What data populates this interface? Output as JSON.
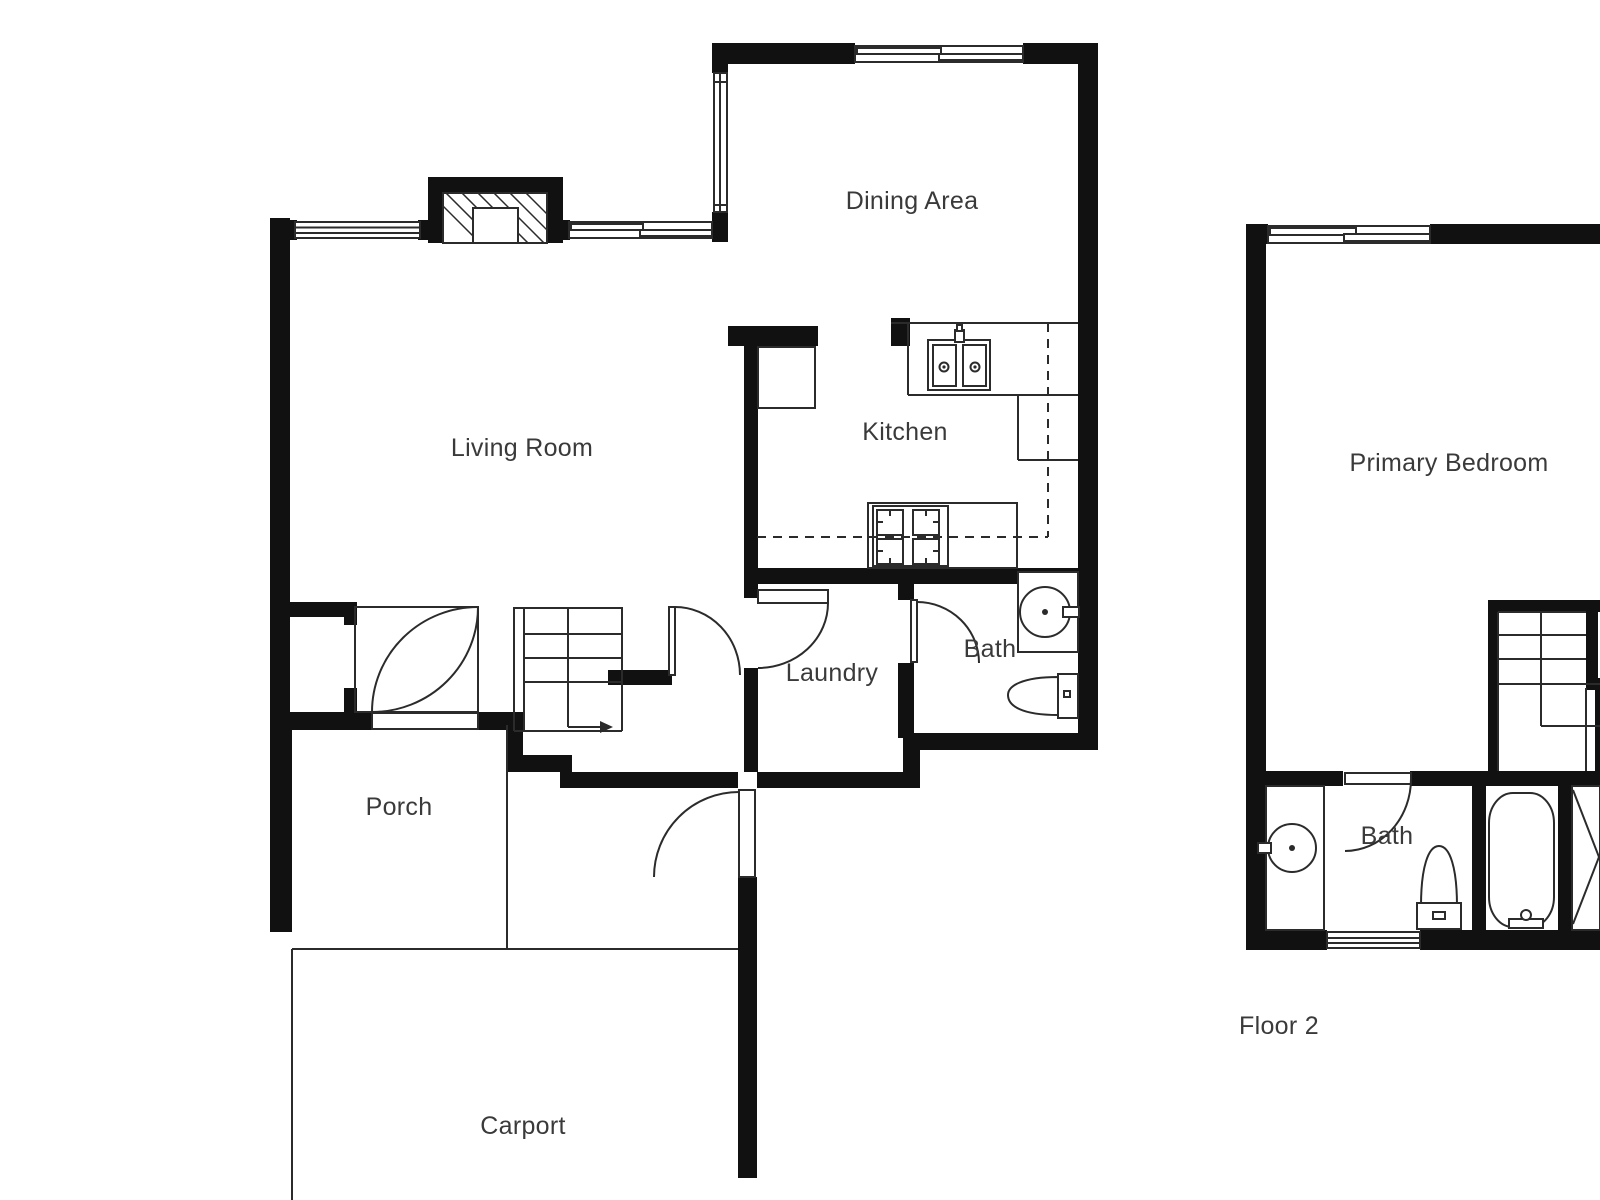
{
  "palette": {
    "wall": "#111111",
    "line": "#2b2b2b",
    "text": "#3a3a3a",
    "bg": "#ffffff"
  },
  "floor1": {
    "rooms": {
      "dining": "Dining Area",
      "living": "Living Room",
      "kitchen": "Kitchen",
      "laundry": "Laundry",
      "bath": "Bath",
      "porch": "Porch",
      "carport": "Carport"
    }
  },
  "floor2": {
    "rooms": {
      "primary_bedroom": "Primary Bedroom",
      "bath": "Bath"
    },
    "caption": "Floor 2"
  }
}
